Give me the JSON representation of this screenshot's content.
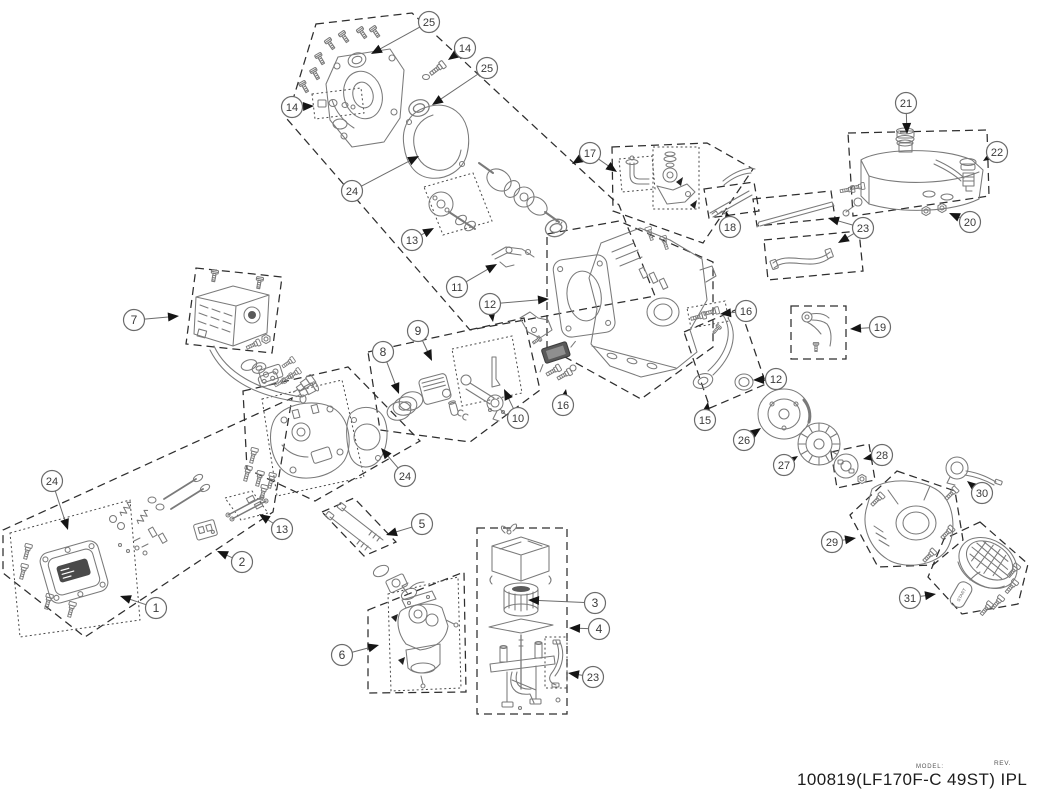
{
  "footer": {
    "model_label": "MODEL:",
    "rev_label": "REV.",
    "title": "100819(LF170F-C 49ST) IPL"
  },
  "recoil_handle_text": "START",
  "colors": {
    "box_outline": "#2e2e2e",
    "part_line": "#7a7a7a",
    "arrow_fill": "#151515",
    "callout_ring": "#6b6b6b",
    "callout_text": "#3a3a3a",
    "background": "#ffffff"
  },
  "diagram": {
    "type": "exploded-parts-diagram",
    "callouts": [
      {
        "num": "1",
        "cx": 156,
        "cy": 608,
        "tips": [
          [
            120,
            596
          ]
        ]
      },
      {
        "num": "2",
        "cx": 242,
        "cy": 562,
        "tips": [
          [
            217,
            551
          ]
        ]
      },
      {
        "num": "3",
        "cx": 595,
        "cy": 603,
        "tips": [
          [
            528,
            600
          ]
        ]
      },
      {
        "num": "4",
        "cx": 599,
        "cy": 629,
        "tips": [
          [
            569,
            628
          ]
        ]
      },
      {
        "num": "5",
        "cx": 422,
        "cy": 524,
        "tips": [
          [
            386,
            535
          ]
        ]
      },
      {
        "num": "6",
        "cx": 342,
        "cy": 655,
        "tips": [
          [
            379,
            645
          ]
        ]
      },
      {
        "num": "7",
        "cx": 134,
        "cy": 320,
        "tips": [
          [
            179,
            316
          ]
        ]
      },
      {
        "num": "8",
        "cx": 383,
        "cy": 352,
        "tips": [
          [
            399,
            394
          ]
        ]
      },
      {
        "num": "9",
        "cx": 418,
        "cy": 331,
        "tips": [
          [
            432,
            361
          ]
        ]
      },
      {
        "num": "10",
        "cx": 518,
        "cy": 418,
        "tips": [
          [
            504,
            389
          ]
        ]
      },
      {
        "num": "11",
        "cx": 457,
        "cy": 287,
        "tips": [
          [
            497,
            264
          ]
        ]
      },
      {
        "num": "12",
        "cx": 490,
        "cy": 304,
        "tips": [
          [
            549,
            299
          ],
          [
            493,
            322
          ]
        ]
      },
      {
        "num": "12",
        "cx": 776,
        "cy": 379,
        "tips": [
          [
            753,
            380
          ]
        ]
      },
      {
        "num": "13",
        "cx": 412,
        "cy": 240,
        "tips": [
          [
            434,
            228
          ]
        ]
      },
      {
        "num": "13",
        "cx": 282,
        "cy": 529,
        "tips": [
          [
            259,
            514
          ]
        ]
      },
      {
        "num": "14",
        "cx": 465,
        "cy": 48,
        "tips": [
          [
            448,
            60
          ]
        ]
      },
      {
        "num": "14",
        "cx": 292,
        "cy": 107,
        "tips": [
          [
            314,
            106
          ]
        ]
      },
      {
        "num": "15",
        "cx": 705,
        "cy": 420,
        "tips": [
          [
            708,
            402
          ]
        ]
      },
      {
        "num": "16",
        "cx": 563,
        "cy": 405,
        "tips": [
          [
            566,
            389
          ]
        ]
      },
      {
        "num": "16",
        "cx": 746,
        "cy": 311,
        "tips": [
          [
            720,
            314
          ]
        ]
      },
      {
        "num": "17",
        "cx": 590,
        "cy": 153,
        "tips": [
          [
            572,
            164
          ],
          [
            617,
            172
          ]
        ]
      },
      {
        "num": "18",
        "cx": 730,
        "cy": 227,
        "tips": [
          [
            726,
            211
          ]
        ]
      },
      {
        "num": "19",
        "cx": 880,
        "cy": 327,
        "tips": [
          [
            850,
            329
          ]
        ]
      },
      {
        "num": "20",
        "cx": 970,
        "cy": 222,
        "tips": [
          [
            949,
            213
          ]
        ]
      },
      {
        "num": "21",
        "cx": 906,
        "cy": 103,
        "tips": [
          [
            907,
            134
          ]
        ]
      },
      {
        "num": "22",
        "cx": 997,
        "cy": 152,
        "tips": [
          [
            983,
            161
          ]
        ]
      },
      {
        "num": "23",
        "cx": 863,
        "cy": 228,
        "tips": [
          [
            828,
            218
          ],
          [
            838,
            243
          ]
        ]
      },
      {
        "num": "23",
        "cx": 593,
        "cy": 677,
        "tips": [
          [
            568,
            673
          ]
        ]
      },
      {
        "num": "24",
        "cx": 352,
        "cy": 191,
        "tips": [
          [
            419,
            156
          ]
        ]
      },
      {
        "num": "24",
        "cx": 52,
        "cy": 481,
        "tips": [
          [
            68,
            530
          ]
        ]
      },
      {
        "num": "24",
        "cx": 405,
        "cy": 476,
        "tips": [
          [
            381,
            448
          ]
        ]
      },
      {
        "num": "25",
        "cx": 429,
        "cy": 22,
        "tips": [
          [
            371,
            54
          ]
        ]
      },
      {
        "num": "25",
        "cx": 487,
        "cy": 68,
        "tips": [
          [
            432,
            105
          ]
        ]
      },
      {
        "num": "26",
        "cx": 744,
        "cy": 440,
        "tips": [
          [
            761,
            428
          ]
        ]
      },
      {
        "num": "27",
        "cx": 784,
        "cy": 465,
        "tips": [
          [
            798,
            456
          ]
        ]
      },
      {
        "num": "28",
        "cx": 882,
        "cy": 455,
        "tips": [
          [
            863,
            459
          ]
        ]
      },
      {
        "num": "29",
        "cx": 832,
        "cy": 542,
        "tips": [
          [
            856,
            538
          ]
        ]
      },
      {
        "num": "30",
        "cx": 982,
        "cy": 493,
        "tips": [
          [
            967,
            481
          ]
        ]
      },
      {
        "num": "31",
        "cx": 910,
        "cy": 598,
        "tips": [
          [
            936,
            594
          ]
        ]
      }
    ]
  }
}
